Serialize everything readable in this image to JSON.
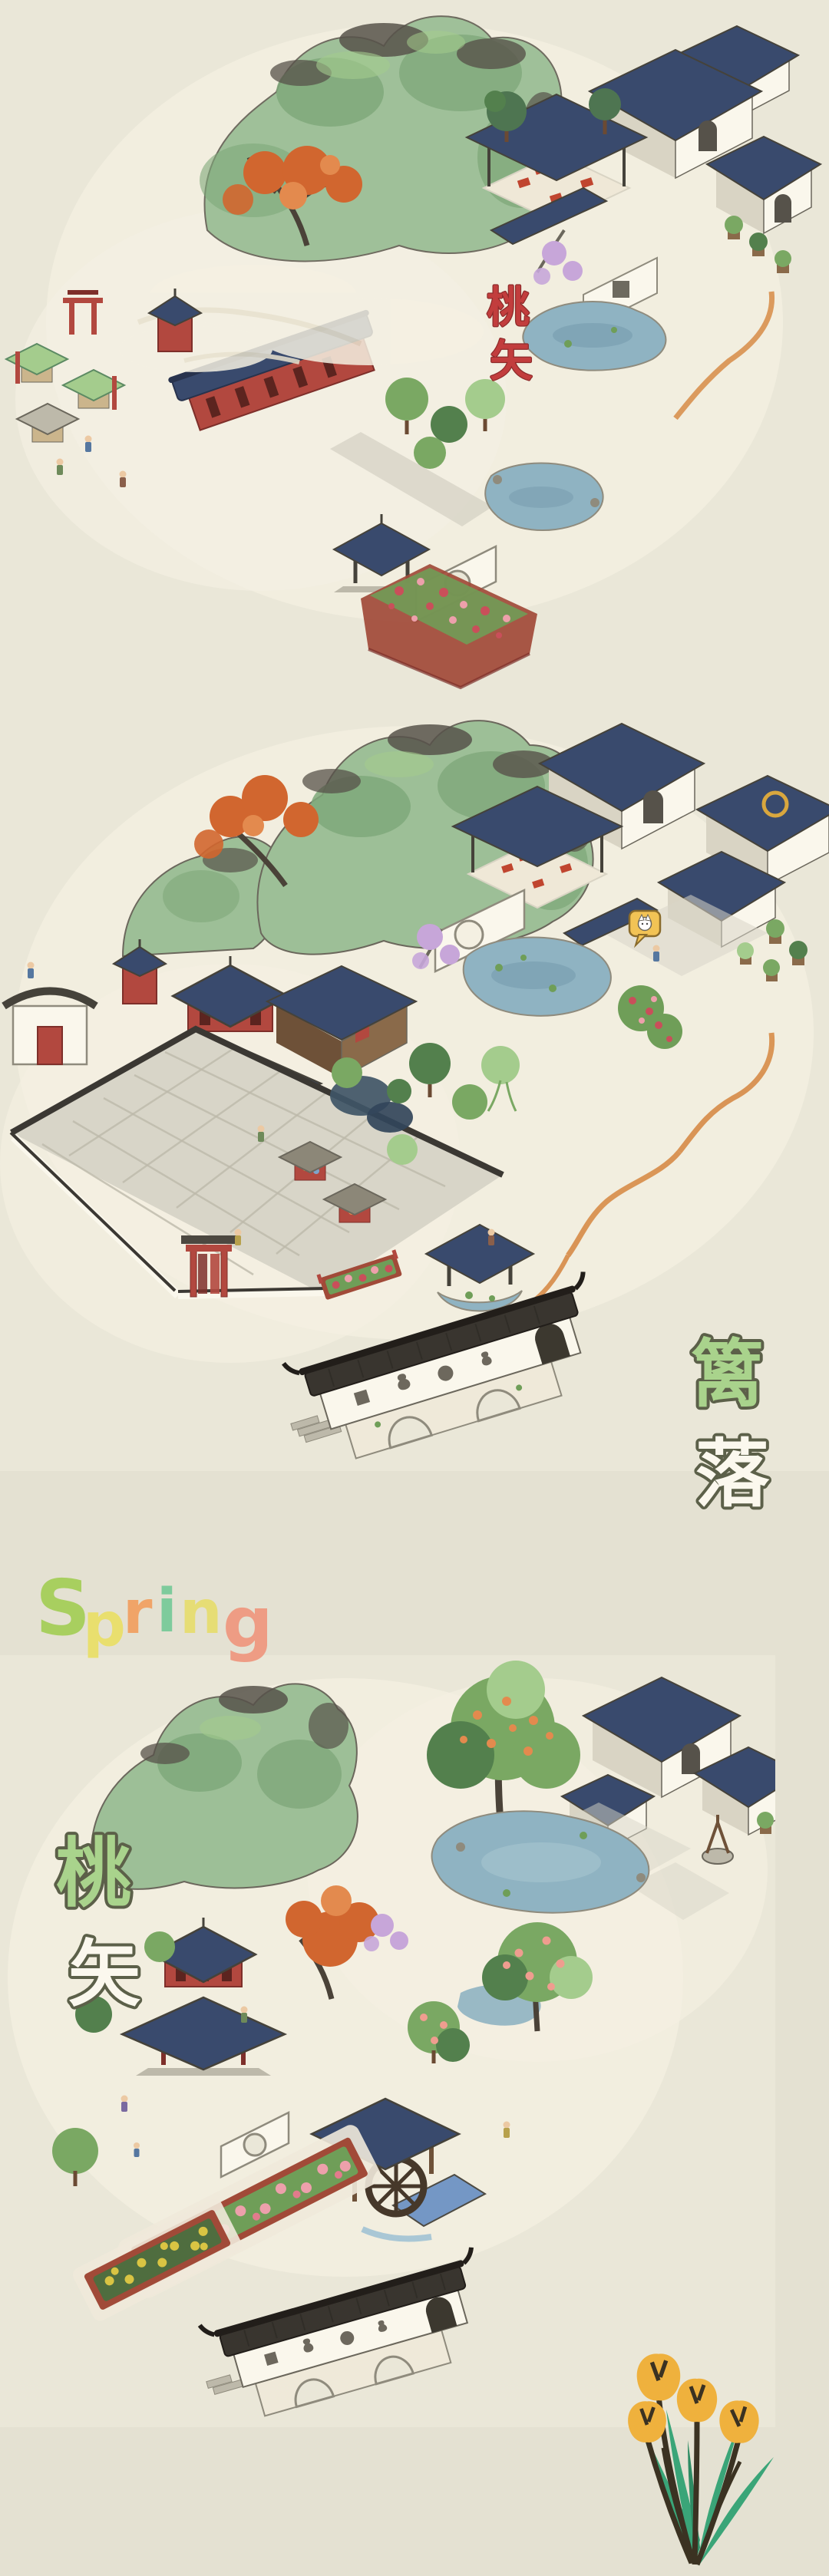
{
  "palette": {
    "page_bg": "#e4e1d2",
    "panel_bg": "#eae7d8",
    "paper": "#f4f0e2",
    "ink": "#45423a",
    "ink_soft": "#6b675c",
    "ink_wash": "#57524a",
    "mountain_green": "#9dbf97",
    "mountain_mid": "#7fa87a",
    "mountain_dark": "#5c8a63",
    "roof_navy": "#394a6d",
    "roof_navy_dark": "#28334d",
    "roof_black": "#39352f",
    "roof_black_dark": "#221e1a",
    "wall_white": "#faf7ec",
    "wall_shadow": "#d9d4c4",
    "wood_red": "#b2483f",
    "wood_red_dark": "#7e2f2a",
    "wood_brown": "#8a6a4a",
    "tree_green": "#7aa863",
    "tree_dark": "#53804d",
    "tree_light": "#a4cc8d",
    "pine_dark": "#4e7551",
    "autumn_orange": "#d1662f",
    "autumn_light": "#e38a4e",
    "peach_pink": "#ef9d8f",
    "blossom_purple": "#c7a6d9",
    "water_blue": "#8fb3c2",
    "water_deep": "#6f94a8",
    "stone_grey": "#d8d5c8",
    "stone_mid": "#bdb9aa",
    "stone_dark": "#8f8b7d",
    "plaza_wall": "#3b3833",
    "cliff_orange": "#d8904f",
    "soil_red": "#a14a38",
    "flower_yellow": "#d9c443",
    "flower_pink": "#eda0ab",
    "rose_red": "#c94f5a",
    "leaf_green": "#6f9e58",
    "label_green": "#a9d38c",
    "label_white": "#fbf8ee",
    "label_outline": "#5c6049",
    "label_red": "#c23d3d",
    "label_red_outline": "#8e2b2b",
    "bubble_yellow": "#f2c355",
    "tulip_petal": "#efb13d",
    "tulip_leaf": "#3aa578",
    "tulip_stem": "#3b3222"
  },
  "panels": [
    {
      "name": "autumn-village-scene",
      "label": {
        "text": "桃矢",
        "orientation": "vertical",
        "chars": [
          "桃",
          "矢"
        ],
        "fill": "#c23d3d",
        "outline": "#8e2b2b"
      }
    },
    {
      "name": "plaza-garden-scene",
      "label": {
        "text": "篱落",
        "orientation": "vertical",
        "chars": [
          {
            "char": "篱",
            "fill": "#a9d38c"
          },
          {
            "char": "落",
            "fill": "#fbf8ee"
          }
        ],
        "outline": "#5c6049"
      },
      "icons": {
        "cat_speech_bubble": {
          "name": "cat-speech-bubble-icon",
          "bubble_color": "#f2c355",
          "glyph": "white-cat-face"
        }
      }
    },
    {
      "name": "spring-garden-scene",
      "heading": {
        "text": "Spring",
        "letters": [
          {
            "char": "S",
            "color": "#a8cf5f"
          },
          {
            "char": "p",
            "color": "#e9df6e"
          },
          {
            "char": "r",
            "color": "#f0a468"
          },
          {
            "char": "i",
            "color": "#7ecb9c"
          },
          {
            "char": "n",
            "color": "#e6dd75"
          },
          {
            "char": "g",
            "color": "#ee9c84"
          }
        ]
      },
      "label": {
        "text": "桃矢",
        "orientation": "vertical",
        "chars": [
          {
            "char": "桃",
            "fill": "#a9d38c"
          },
          {
            "char": "矢",
            "fill": "#fbf8ee"
          }
        ],
        "outline": "#5c6049"
      },
      "illustration": {
        "name": "yellow-tulips-illustration",
        "tulip_count": 4,
        "petal_color": "#efb13d",
        "leaf_color": "#3aa578",
        "stem_color": "#3b3222"
      }
    }
  ]
}
